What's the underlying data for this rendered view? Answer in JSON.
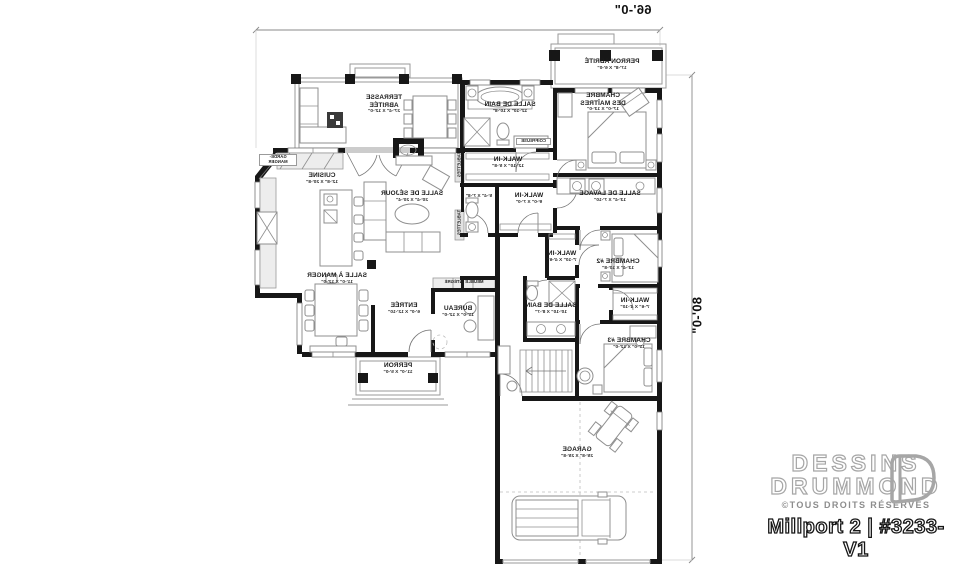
{
  "dimensions": {
    "width": "66'-0\"",
    "depth": "80'-0\""
  },
  "rooms": {
    "terrasse": {
      "name": "TERRASSE ABRITÉE",
      "size": "27'-4\" X 12'-0\""
    },
    "cuisine": {
      "name": "CUISINE",
      "size": "12'-8\" X 20'-8\""
    },
    "sejour": {
      "name": "SALLE DE SÉJOUR",
      "size": "20'-4\" X 20'-4\""
    },
    "salle_a_manger": {
      "name": "SALLE À MANGER",
      "size": "11'-0\" X 12'-0\""
    },
    "entree": {
      "name": "ENTRÉE",
      "size": "6'-0\" X 12'-10\""
    },
    "bureau": {
      "name": "BUREAU",
      "size": "11'-0\" X 12'-0\""
    },
    "perron": {
      "name": "PERRON",
      "size": "11'-0\" X 5'-0\""
    },
    "perron_abrite": {
      "name": "PERRON ABRITÉ",
      "size": "17'-8\" X 6'-0\""
    },
    "chambre_maitres": {
      "name": "CHAMBRE DES MAÎTRES",
      "size": "17'-0\" X 13'-0\""
    },
    "bain_maitres": {
      "name": "SALLE DE BAIN",
      "size": "12'-10\" X 10'-8\""
    },
    "walkin_maitres": {
      "name": "WALK-IN",
      "size": "12'-10\" X 5'-8\""
    },
    "wc": {
      "size": "5'-4\" X 7'-8\""
    },
    "walkin2": {
      "name": "WALK-IN",
      "size": "9'-0\" X 7'-0\""
    },
    "lavage": {
      "name": "SALLE DE LAVAGE",
      "size": "13'-4\" X 7'-10\""
    },
    "chambre2": {
      "name": "CHAMBRE #2",
      "size": "13'-4\" X 10'-8\""
    },
    "walkin_ch2": {
      "name": "WALK-IN",
      "size": "7'-10\" X 4'-6\""
    },
    "bain2": {
      "name": "SALLE DE BAIN",
      "size": "10'-10\" X 8'-7\""
    },
    "walkin_ch3": {
      "name": "WALK-IN",
      "size": "7'-6\" X 4'-10\""
    },
    "chambre3": {
      "name": "CHAMBRE #3",
      "size": "11'-0\" X 12'-0\""
    },
    "garage": {
      "name": "GARAGE",
      "size": "25'-8\" X 25'-8\""
    },
    "garde_manger": {
      "name": "GARDE-MANGER"
    },
    "coiffeuse": {
      "name": "COIFFEUSE"
    },
    "meuble": {
      "name": "MEUBLE INTÉGRÉ"
    },
    "tablettes": {
      "name": "TABLETTES"
    }
  },
  "branding": {
    "line1": "DESSINS",
    "line2": "DRUMMOND",
    "rights": "©TOUS DROITS RÉSERVÉS",
    "plan": "Millport 2 | #3233-V1"
  },
  "colors": {
    "wall": "#171717",
    "furniture": "#8f8f8f",
    "brand_outline": "#a6a6a6"
  }
}
